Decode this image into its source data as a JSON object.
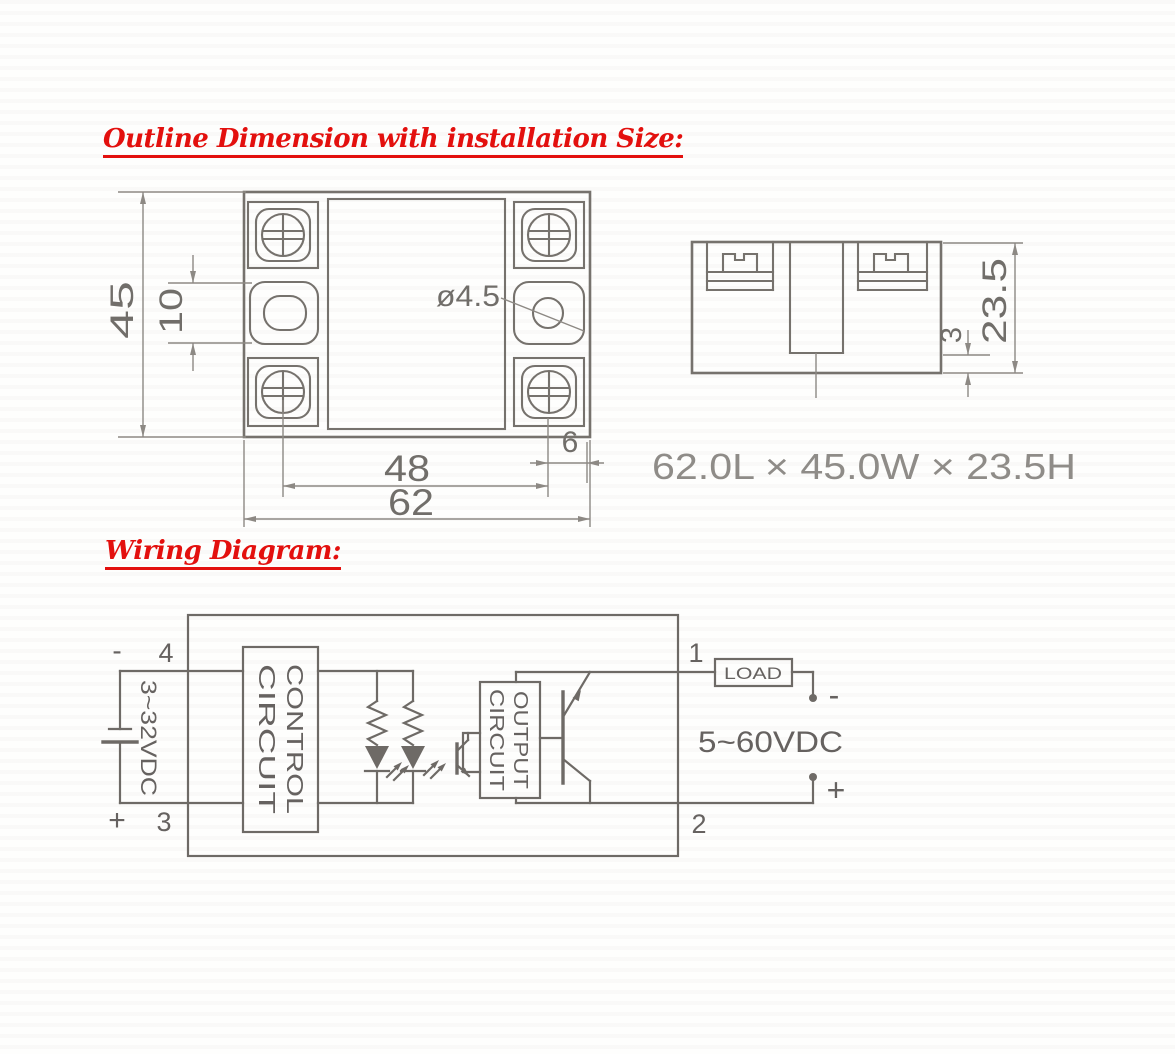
{
  "headings": {
    "outline": "Outline Dimension with installation Size:",
    "wiring": "Wiring Diagram:"
  },
  "outline_figure": {
    "plan_view": {
      "height_dim": "45",
      "slot_dim": "10",
      "hole_dia": "ø4.5",
      "mount_span_dim": "48",
      "width_dim": "62",
      "edge_dim": "6"
    },
    "side_view": {
      "height_dim": "23.5",
      "base_step_dim": "3"
    },
    "overall_size": "62.0L × 45.0W × 23.5H"
  },
  "wiring": {
    "terminal_4": "4",
    "terminal_3": "3",
    "terminal_1": "1",
    "terminal_2": "2",
    "input_minus": "-",
    "input_plus": "+",
    "input_voltage": "3~32VDC",
    "control_box_line1": "CONTROL",
    "control_box_line2": "CIRCUIT",
    "output_box_line1": "OUTPUT",
    "output_box_line2": "CIRCUIT",
    "load_label": "LOAD",
    "output_voltage": "5~60VDC",
    "output_minus": "-",
    "output_plus": "+"
  },
  "colors": {
    "heading_red": "#e3100e",
    "drawing_line_gray": "#76726d",
    "dimension_gray": "#8d8984",
    "label_gray": "#716e6a",
    "size_text_gray": "#8f8c88"
  }
}
